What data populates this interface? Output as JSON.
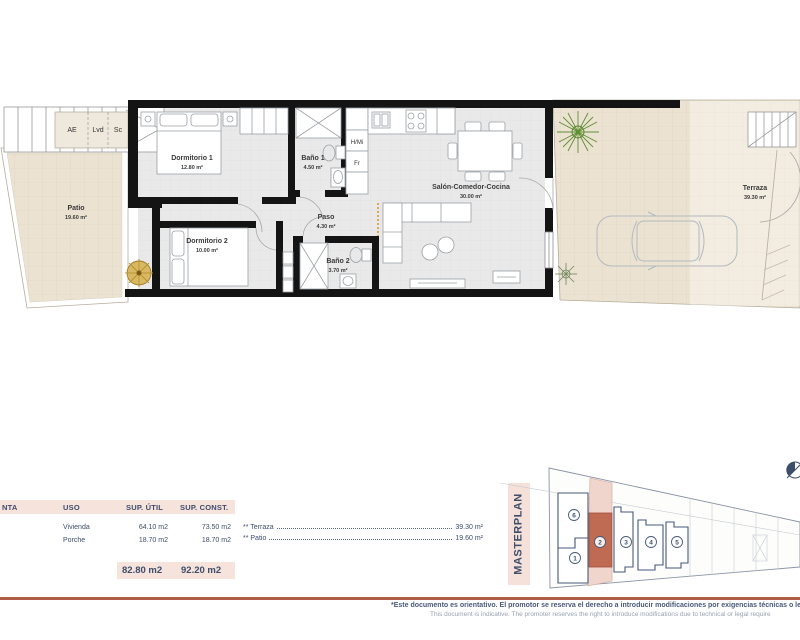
{
  "plan": {
    "closets": [
      "AE",
      "Lvd",
      "Sc"
    ],
    "appliances": [
      "H/Mi",
      "Fr"
    ],
    "rooms": [
      {
        "name": "Patio",
        "area": "19.60 m²"
      },
      {
        "name": "Dormitorio 1",
        "area": "12.80 m²"
      },
      {
        "name": "Baño 1",
        "area": "4.50 m²"
      },
      {
        "name": "Paso",
        "area": "4.30 m²"
      },
      {
        "name": "Dormitorio 2",
        "area": "10.00 m²"
      },
      {
        "name": "Baño 2",
        "area": "3.70 m²"
      },
      {
        "name": "Salón-Comedor-Cocina",
        "area": "30.00 m²"
      },
      {
        "name": "Terraza",
        "area": "39.30 m²"
      }
    ]
  },
  "table": {
    "headers": {
      "planta": "NTA",
      "uso": "USO",
      "util": "SUP. ÚTIL",
      "const": "SUP. CONST."
    },
    "rows": [
      {
        "uso": "Vivienda",
        "util": "64.10 m2",
        "const": "73.50 m2"
      },
      {
        "uso": "Porche",
        "util": "18.70 m2",
        "const": "18.70 m2"
      }
    ],
    "totals": {
      "util": "82.80 m2",
      "const": "92.20 m2"
    },
    "notes": [
      {
        "label": "** Terraza",
        "value": "39.30 m²"
      },
      {
        "label": "** Patio",
        "value": "19.60 m²"
      }
    ]
  },
  "masterplan": {
    "title": "MASTERPLAN",
    "units": [
      "6",
      "1",
      "2",
      "3",
      "4",
      "5"
    ],
    "highlighted_unit": "2"
  },
  "footer": {
    "disclaimer_es": "*Este documento es orientativo. El promotor se reserva el derecho a introducir modificaciones por exigencias técnicas o le",
    "disclaimer_en": "This document is indicative. The promoter reserves the right to introduce modifications due to technical or legal require"
  },
  "colors": {
    "accent_terracotta": "#bf6b54",
    "pink_band": "#f5e3dc",
    "navy_text": "#3d4d6b",
    "footer_bar": "#b05c46",
    "beige_floor": "#ece3d3"
  }
}
